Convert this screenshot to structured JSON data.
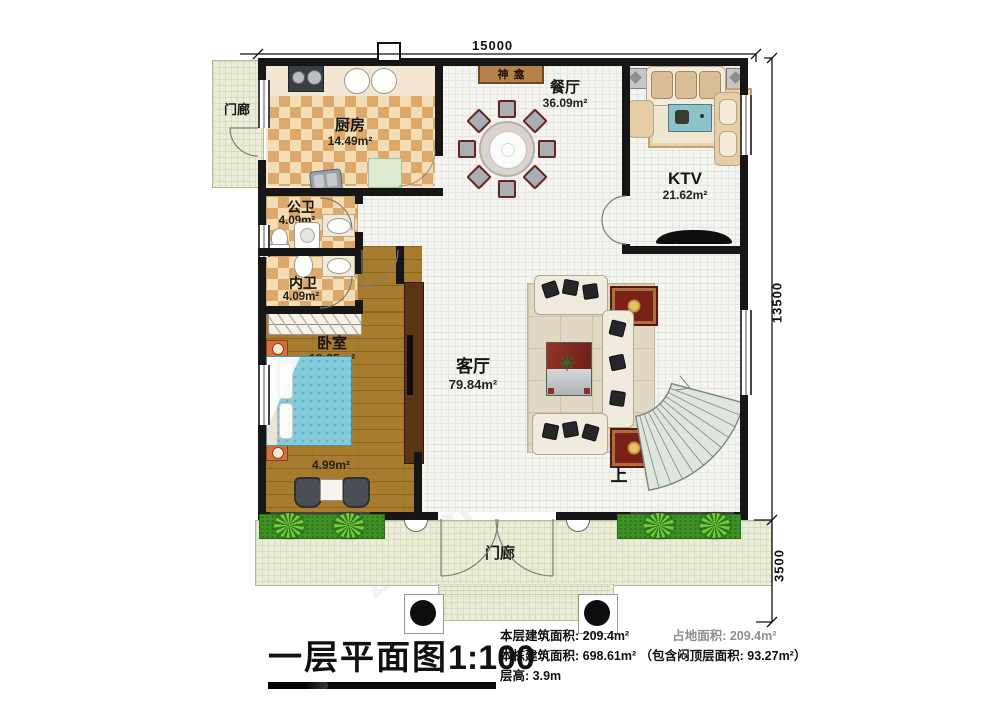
{
  "plan": {
    "dim_top": "15000",
    "dim_right": "13500",
    "dim_bottom_right": "3500",
    "stairs_label": "上",
    "rooms": {
      "porch_left": {
        "name": "门廊"
      },
      "porch_bottom": {
        "name": "门廊"
      },
      "kitchen": {
        "name": "厨房",
        "area": "14.49m²"
      },
      "shrine": {
        "name": "神龛"
      },
      "dining": {
        "name": "餐厅",
        "area": "36.09m²"
      },
      "ktv": {
        "name": "KTV",
        "area": "21.62m²"
      },
      "public_bath": {
        "name": "公卫",
        "area": "4.09m²"
      },
      "inner_bath": {
        "name": "内卫",
        "area": "4.09m²"
      },
      "bedroom": {
        "name": "卧室",
        "area": "18.85m²"
      },
      "sitting_nook": {
        "area": "4.99m²"
      },
      "living": {
        "name": "客厅",
        "area": "79.84m²"
      }
    }
  },
  "title_block": {
    "title": "一层平面图",
    "scale": "1:100",
    "floor_area_label": "本层建筑面积:",
    "floor_area_value": "209.4m²",
    "land_area_label": "占地面积:",
    "land_area_value": "209.4m²",
    "building_area_label": "本栋建筑面积:",
    "building_area_value": "698.61m²",
    "attic_note": "（包含闷顶层面积: 93.27m²）",
    "height_label": "层高:",
    "height_value": "3.9m"
  },
  "watermark": "z.com"
}
